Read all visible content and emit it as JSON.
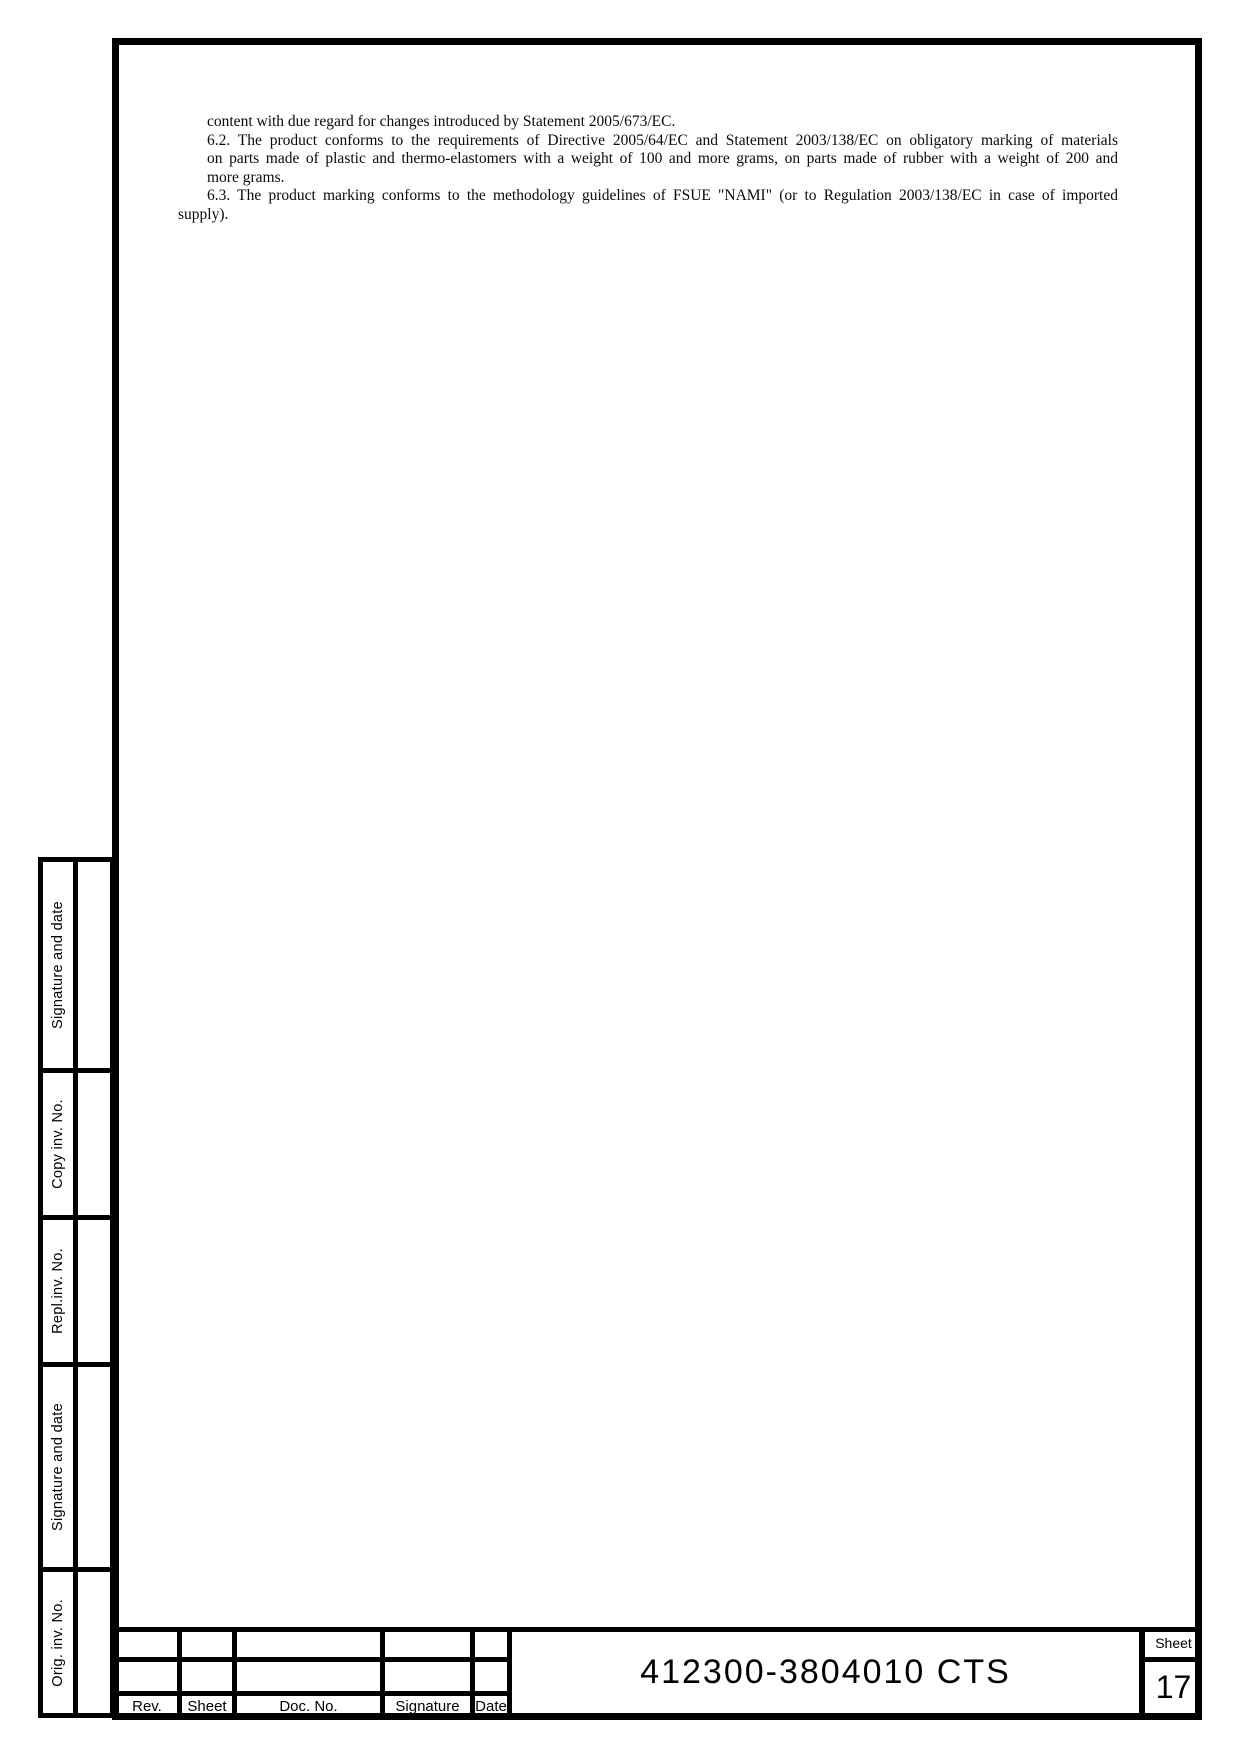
{
  "document": {
    "body_lines": [
      "content with due regard for changes introduced by Statement 2005/673/EC.",
      "6.2. The product conforms to the requirements of Directive 2005/64/EC and Statement 2003/138/EC on obligatory marking of materials",
      "on parts made of plastic and thermo-elastomers with a weight of 100 and more grams, on parts made of rubber with a weight of 200 and",
      "more grams.",
      "6.3. The product marking conforms to the methodology guidelines of FSUE \"NAMI\" (or to Regulation 2003/138/EC in case of imported",
      "supply)."
    ]
  },
  "sidebar": {
    "sections": [
      {
        "label": "Signature and date"
      },
      {
        "label": "Copy inv. No."
      },
      {
        "label": "Repl.inv. No."
      },
      {
        "label": "Signature and date"
      },
      {
        "label": "Orig. inv. No."
      }
    ]
  },
  "title_block": {
    "col_headers": [
      "Rev.",
      "Sheet",
      "Doc. No.",
      "Signature",
      "Date"
    ],
    "doc_number": "412300-3804010 CTS",
    "sheet_box": {
      "label": "Sheet",
      "number": "17"
    }
  },
  "colors": {
    "ink": "#000000",
    "paper": "#ffffff"
  }
}
